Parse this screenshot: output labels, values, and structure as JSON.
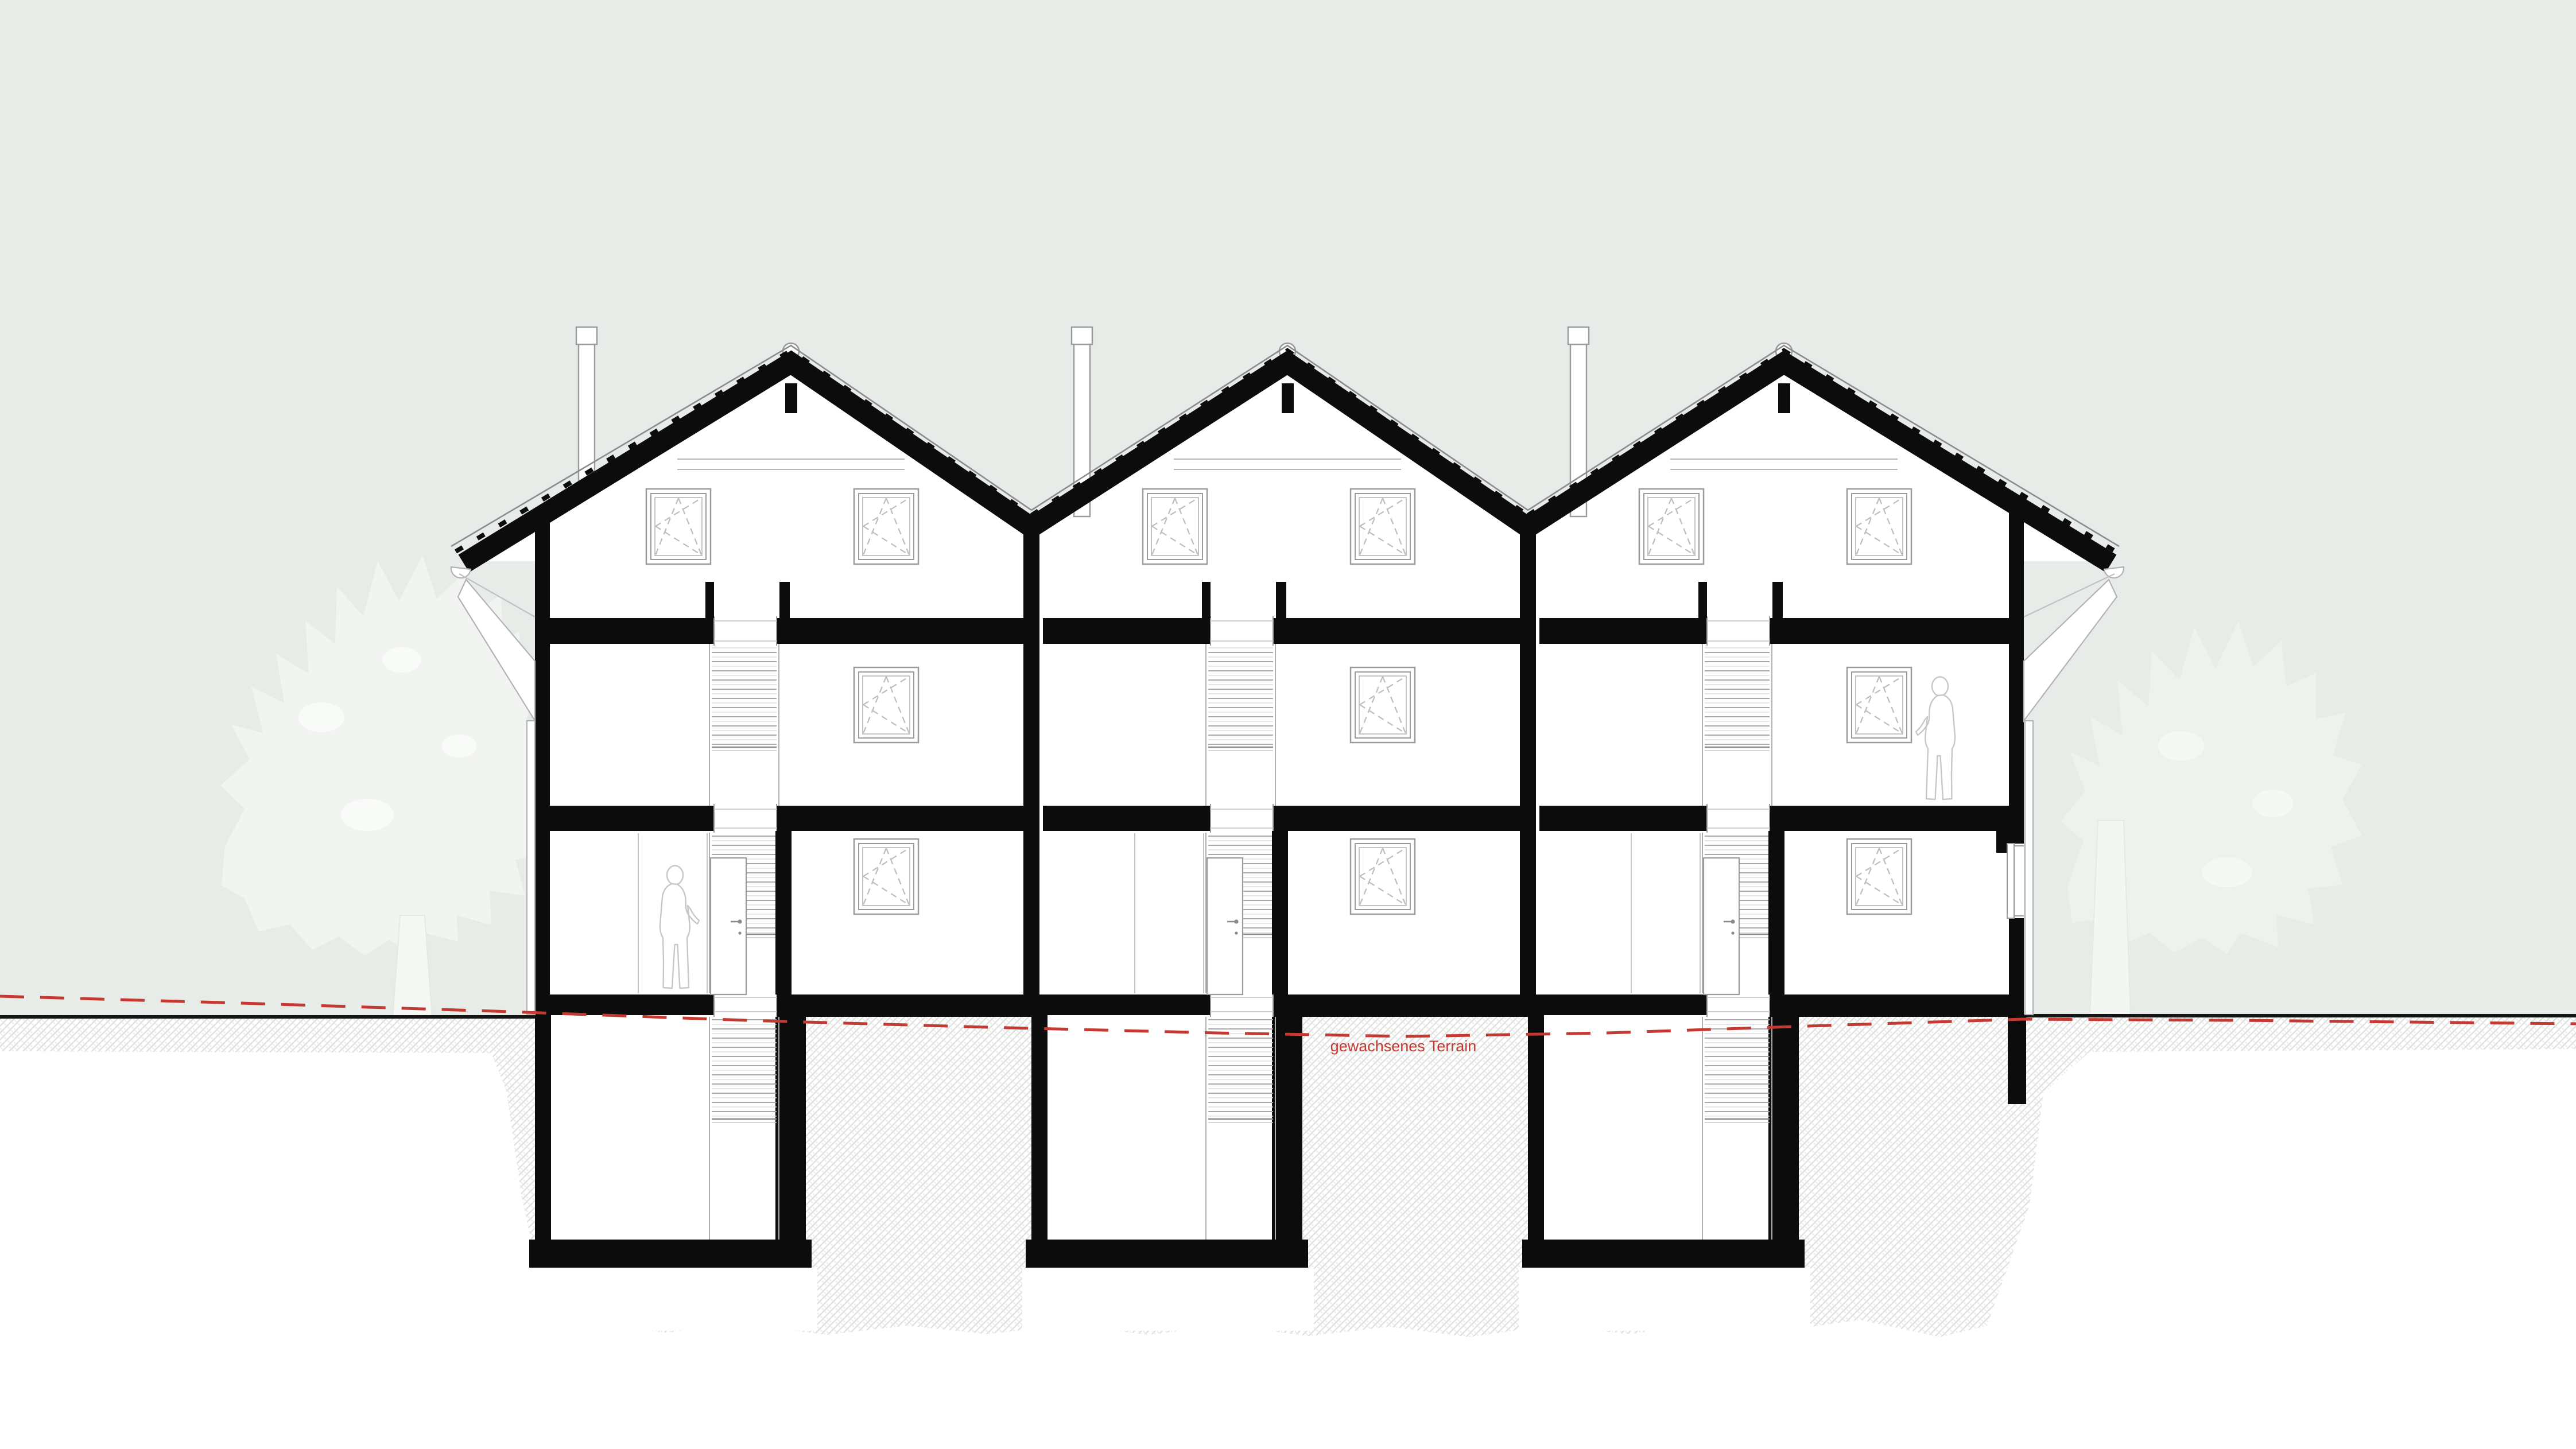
{
  "annotations": {
    "terrain_label": "gewachsenes Terrain"
  },
  "palette": {
    "sky": "#e8ece8",
    "paper": "#ffffff",
    "section_black": "#0c0c0c",
    "detail_gray": "#9a9a9a",
    "light_gray": "#c7c7c7",
    "hatch_gray": "#dcdfdc",
    "terrain_red": "#c43a32",
    "tree_fill": "#f1f4f0"
  },
  "structure": {
    "kind": "cross-section drawing of a three-unit gabled row house",
    "units": 3,
    "levels": [
      "attic",
      "upper floor",
      "ground floor",
      "basement"
    ],
    "windows_per_unit": 4,
    "stairs_per_unit": 1,
    "chimneys": 3,
    "ridge_vents": 3,
    "human_figures": 2,
    "trees": 2
  }
}
